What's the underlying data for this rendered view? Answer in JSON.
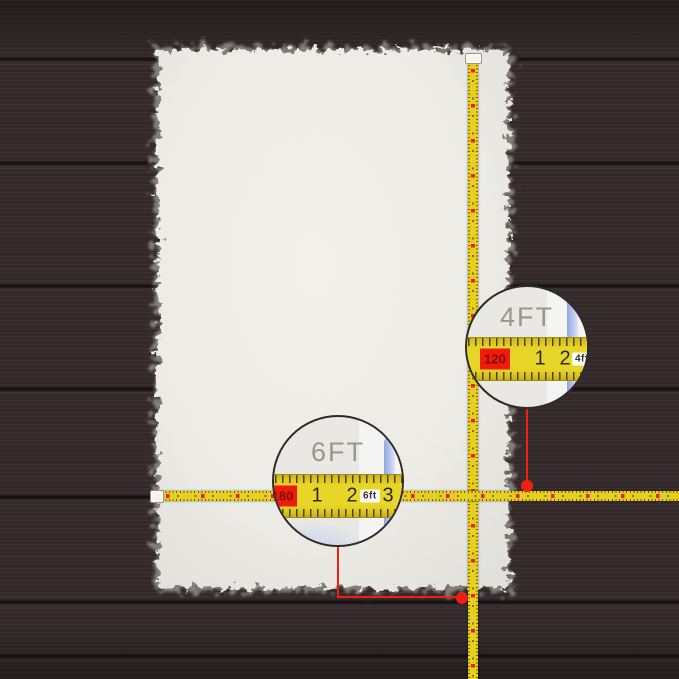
{
  "annotations": {
    "width_callout": {
      "label": "4FT",
      "cm_mark": "120",
      "inch_marks": [
        "1",
        "2",
        "3"
      ],
      "ft_mark": "4ft"
    },
    "length_callout": {
      "label": "6FT",
      "cm_mark": "180",
      "inch_marks": [
        "1",
        "2",
        "3"
      ],
      "ft_mark": "6ft"
    }
  },
  "colors": {
    "floor_brown": "#342a2b",
    "plank_seam": "#150e0f",
    "rug_ivory": "#efede8",
    "tape_yellow": "#e6cf1d",
    "marker_red": "#ee2113",
    "leader_red": "#ef2012",
    "cm_box_red": "#f2190d",
    "magnifier_edge_blue": "#b9c8ee",
    "dimension_label_gray": "#98978f"
  }
}
